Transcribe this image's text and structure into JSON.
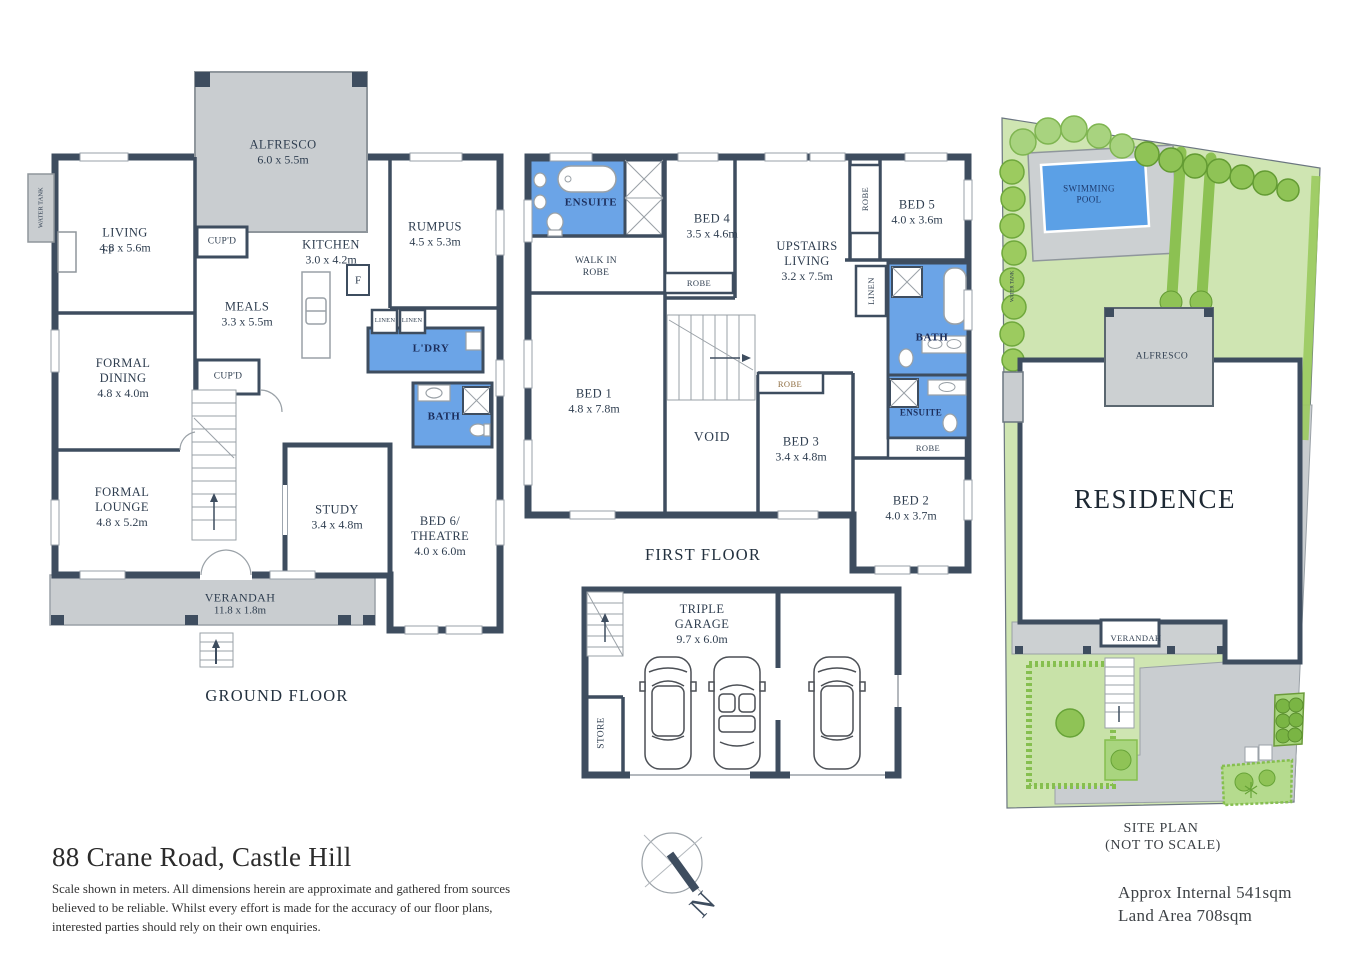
{
  "address": "88 Crane Road, Castle Hill",
  "disclaimer": "Scale shown in meters. All dimensions herein are approximate and gathered from sources believed to be  reliable. Whilst every effort is made for the accuracy of our floor plans, interested parties should rely on their own enquiries.",
  "compass": {
    "north": "N"
  },
  "colors": {
    "wall": "#3e4d5f",
    "wet_area": "#6ba4e7",
    "hard_surface": "#c9cdd0",
    "lawn": "#cfe5b2",
    "pool": "#5ba0e6",
    "tree": "#8fc356"
  },
  "ground_floor": {
    "title": "GROUND FLOOR",
    "rooms": {
      "alfresco": {
        "name": "ALFRESCO",
        "dims": "6.0 x 5.5m"
      },
      "living": {
        "name": "LIVING",
        "dims": "4.8 x 5.6m"
      },
      "kitchen": {
        "name": "KITCHEN",
        "dims": "3.0 x 4.2m"
      },
      "rumpus": {
        "name": "RUMPUS",
        "dims": "4.5 x 5.3m"
      },
      "meals": {
        "name": "MEALS",
        "dims": "3.3 x 5.5m"
      },
      "formal_dining": {
        "name": "FORMAL DINING",
        "dims": "4.8 x 4.0m"
      },
      "formal_lounge": {
        "name": "FORMAL LOUNGE",
        "dims": "4.8 x 5.2m"
      },
      "study": {
        "name": "STUDY",
        "dims": "3.4 x 4.8m"
      },
      "bed6": {
        "name": "BED 6/ THEATRE",
        "dims": "4.0 x 6.0m"
      },
      "verandah": {
        "name": "VERANDAH",
        "dims": "11.8 x 1.8m"
      },
      "laundry": {
        "name": "L'DRY"
      },
      "bath": {
        "name": "BATH"
      },
      "cupboard_top": {
        "name": "CUP'D"
      },
      "cupboard_hall": {
        "name": "CUP'D"
      },
      "linen_left": {
        "name": "LINEN"
      },
      "linen_right": {
        "name": "LINEN"
      },
      "fridge": {
        "name": "F"
      },
      "fireplace": {
        "name": "FP"
      },
      "water_tank": {
        "name": "WATER TANK"
      }
    }
  },
  "first_floor": {
    "title": "FIRST FLOOR",
    "rooms": {
      "ensuite_main": {
        "name": "ENSUITE"
      },
      "walk_in_robe": {
        "name": "WALK IN ROBE"
      },
      "bed4": {
        "name": "BED 4",
        "dims": "3.5 x 4.6m"
      },
      "upstairs_living": {
        "name": "UPSTAIRS LIVING",
        "dims": "3.2 x 7.5m"
      },
      "bed5": {
        "name": "BED 5",
        "dims": "4.0 x 3.6m"
      },
      "robe_bed5": {
        "name": "ROBE"
      },
      "linen": {
        "name": "LINEN"
      },
      "bath": {
        "name": "BATH"
      },
      "bed1": {
        "name": "BED 1",
        "dims": "4.8 x 7.8m"
      },
      "void": {
        "name": "VOID"
      },
      "robe_bed4": {
        "name": "ROBE"
      },
      "robe_bed3": {
        "name": "ROBE"
      },
      "bed3": {
        "name": "BED 3",
        "dims": "3.4 x 4.8m"
      },
      "ensuite2": {
        "name": "ENSUITE"
      },
      "robe_bed2": {
        "name": "ROBE"
      },
      "bed2": {
        "name": "BED 2",
        "dims": "4.0 x 3.7m"
      }
    }
  },
  "garage": {
    "rooms": {
      "garage": {
        "name": "TRIPLE GARAGE",
        "dims": "9.7 x 6.0m"
      },
      "store": {
        "name": "STORE"
      }
    }
  },
  "site_plan": {
    "title_line1": "SITE PLAN",
    "title_line2": "(NOT TO SCALE)",
    "approx_internal": "Approx Internal 541sqm",
    "land_area": "Land Area 708sqm",
    "labels": {
      "swimming_pool": "SWIMMING POOL",
      "residence": "RESIDENCE",
      "alfresco": "ALFRESCO",
      "verandah": "VERANDAH",
      "water_tank": "WATER TANK"
    }
  }
}
